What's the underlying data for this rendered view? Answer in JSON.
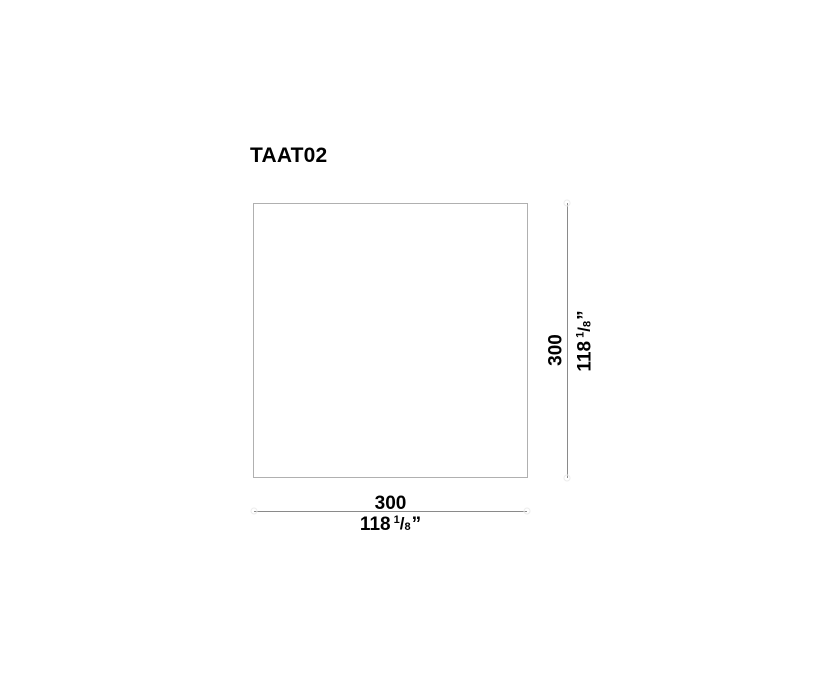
{
  "title": "TAAT02",
  "drawing": {
    "shape": "square-outline"
  },
  "dimensions": {
    "width": {
      "metric": "300",
      "imperial_whole": "118",
      "imperial_numerator": "1",
      "fraction_slash": "/",
      "imperial_denominator": "8",
      "unit_mark": "”"
    },
    "height": {
      "metric": "300",
      "imperial_whole": "118",
      "imperial_numerator": "1",
      "fraction_slash": "/",
      "imperial_denominator": "8",
      "unit_mark": "”"
    }
  },
  "colors": {
    "background": "#ffffff",
    "text": "#000000",
    "outline": "#b0b0b0",
    "dimension-line": "#8a8a8a",
    "end-marker": "#ececec"
  }
}
